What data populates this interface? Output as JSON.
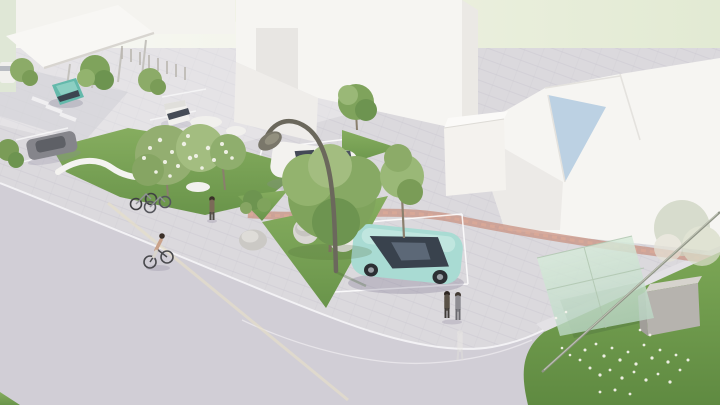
{
  "scene": {
    "kind": "architectural-3d-render",
    "view": "aerial perspective of landscaped plaza with parking, street and bus shelter",
    "objects": {
      "sky": "pale green backdrop",
      "canopy_building": "white entrance canopy with columns",
      "white_building_block": "large white building volume",
      "gabled_building": "large white gabled building",
      "blue_roof_plane": "light blue roof plane",
      "annex_cube": "small white cubic annex",
      "plaza": "paved plaza and parking court",
      "road": "asphalt street in foreground",
      "curb": "white curb edge line",
      "brick_path": "red clinker paver path",
      "beige_path": "beige crossing path on road",
      "grass_island_left": "grass island with white play ribbon",
      "grass_triangle": "triangular grass island",
      "lawn": "flowering lawn at bus stop",
      "curved_lamp": "curved sculptural street lamp",
      "glass_shelter": "glass bus-shelter canopy",
      "utility_box": "grey utility cabinet",
      "boulder": "round stone boulder",
      "tree_planter": "white circular tree planter",
      "white_car": "white parked car",
      "teal_car": "teal parked car",
      "gray_car": "grey parked car",
      "teal_van": "teal van on access road",
      "white_van": "white parked van",
      "white_van_left": "white van at left edge",
      "bicycles": "two parked bicycles",
      "cyclist": "person riding bicycle",
      "pedestrian": "standing pedestrian",
      "pedestrian_pair": "two pedestrians near parking",
      "ghost_figure": "faint walking figure",
      "trees": "green trees",
      "blossom_tree": "white blossoming trees",
      "parking_markings": "white parking stall markings",
      "flowers": "white lawn flowers"
    }
  },
  "colors": {
    "sky_left": "#f5f5f0",
    "sky_right": "#e3ebd4",
    "plaza": "#dbd9dd",
    "road": "#d1ced6",
    "curb": "#f3f2f5",
    "grass": "#7aa254",
    "grass_dark": "#648c44",
    "lawn": "#6f9a4d",
    "brick": "#c78f7e",
    "beige": "#e6dfc8",
    "building": "#f6f5f2",
    "building_shade": "#e9e7e3",
    "roof_blue": "#b6cde2",
    "glass": "#cfe3d3",
    "lamp": "#6b685c",
    "car_teal": "#a9dbd3",
    "car_white": "#f3f2ef",
    "car_gray": "#85858b",
    "van_teal": "#64b9ab",
    "box_gray": "#b6b3ae",
    "tree": "#7fa35c",
    "tree_light": "#9ab877",
    "blossom": "#eef0e4"
  }
}
